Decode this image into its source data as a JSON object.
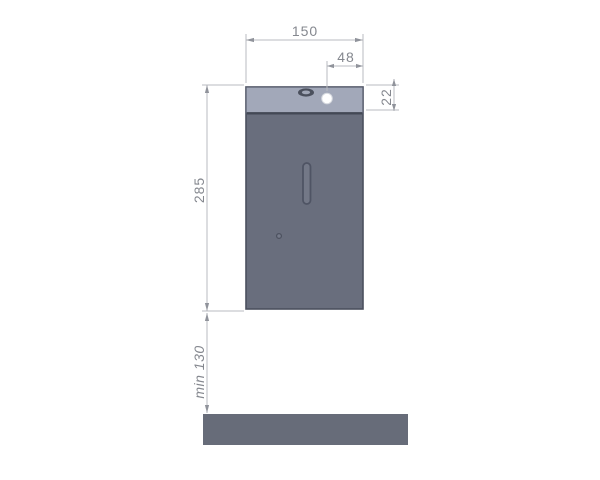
{
  "drawing": {
    "dimension_labels": {
      "overall_width": "150",
      "button_inset": "48",
      "cover_height": "22",
      "body_height": "285",
      "clearance_below": "min 130"
    },
    "colors": {
      "background": "#ffffff",
      "body_fill": "#696e7d",
      "cover_fill": "#a2a8b9",
      "shelf_fill": "#676c79",
      "outline": "#4b505e",
      "separator": "#434855",
      "dimension_line": "#b9bbc1",
      "dimension_text": "#85888f",
      "button_fill": "#ffffff"
    },
    "icons": {
      "sensor": "oval-sensor-icon",
      "button": "round-button-icon",
      "sight_window": "sight-slot",
      "keyhole": "keyhole-dot-icon"
    }
  }
}
